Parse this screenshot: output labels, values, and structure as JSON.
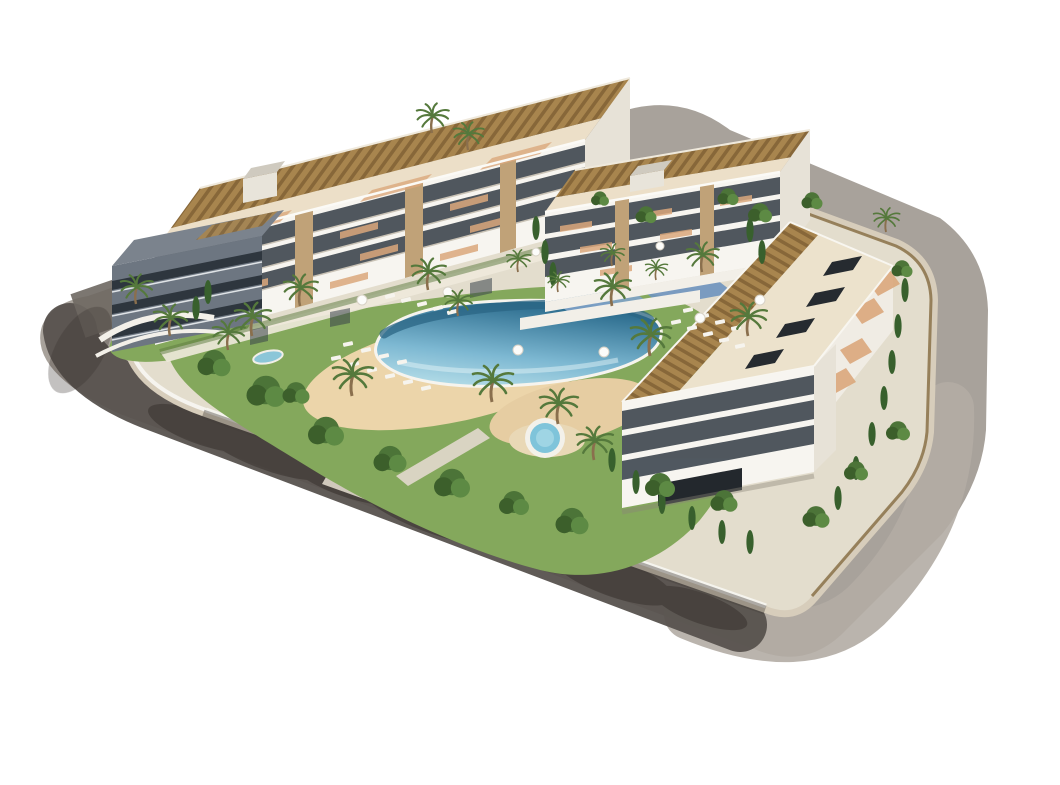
{
  "scene": {
    "type": "architectural-render-aerial",
    "aria_label": "Aerial 3D architectural rendering of a modern white apartment complex with rooftop pergolas, a landscaped courtyard with a lagoon-style swimming pool and sandy beach, a round jacuzzi, palm trees, cypresses and a surrounding ring road",
    "background": "#ffffff"
  },
  "site": {
    "road": {
      "surface_light": "#a8a29b",
      "surface_sunlit": "#b2aca4",
      "surface_shaded": "#57524e",
      "tree_shadow": "#352f2b",
      "sidewalk": "#d7cdbb",
      "entrance_apron": "#d8d1c3"
    },
    "plot": {
      "base": "#e3ddcd",
      "perimeter_wall": "#f6f4ef",
      "lawn": "#84a85c",
      "lawn_dark": "#5d7a40",
      "beach_sand": "#ecd5aa",
      "beach_sand_dark": "#e6cda2",
      "fence": "#8a7148",
      "driveway": "#ddd6c7",
      "walkway": "#eee9db"
    },
    "pool": {
      "water_shallow": "#bfe4ec",
      "water_mid": "#7db8d2",
      "water_deep": "#2f6f90",
      "deep_band": "#2b6584",
      "coping": "#f6f4ee"
    },
    "jacuzzi": {
      "water": "#7fc4da",
      "rim": "#f3f1ea",
      "deck": "#e9d8b6"
    },
    "blue_decks": {
      "deck_a": "#7fa2c8",
      "deck_b": "#6e94bf"
    },
    "pond": {
      "water": "#8cc6d8"
    }
  },
  "buildings": {
    "count": 4,
    "facade_white": "#f7f5f0",
    "facade_shaded": "#e7e2d7",
    "window_band": "#39424b",
    "door_dark": "#23282d",
    "stone_pillar": "#c0a278",
    "pergola": "#a8854e",
    "pergola_slat": "#876739",
    "roof_front": "#ecdfc8",
    "roof_deck": "#ece2cc",
    "terrace_terracotta": "#dba87c",
    "roof_box": "#262b30",
    "bulkhead": "#e8e4da",
    "dark_wing_facade": "#6d7681",
    "dark_wing_band": "#2e363e",
    "blocks": [
      {
        "id": "north-west-block",
        "floors_visible": 4,
        "features": [
          "rooftop pergolas",
          "stone pillars",
          "balcony window bands",
          "roof bulkhead"
        ]
      },
      {
        "id": "north-east-block",
        "floors_visible": 4,
        "features": [
          "rooftop pergolas",
          "roof bulkhead",
          "podium blue decks"
        ]
      },
      {
        "id": "east-block",
        "floors_visible": 4,
        "features": [
          "pergola roof band",
          "roof skylight boxes",
          "street terraces",
          "garage door"
        ]
      },
      {
        "id": "west-shaded-wing",
        "floors_visible": 3,
        "features": [
          "shaded gable facade",
          "dark window strips",
          "curved planter walls"
        ]
      }
    ]
  },
  "vegetation": {
    "palm_frond": "#55793c",
    "leafy": "#4c7438",
    "leafy_dark": "#3c5f2b",
    "leafy_light": "#5d8a44",
    "cypress": "#38602d",
    "trunk": "#8a6f4d"
  },
  "furniture": {
    "lounger": "#f6f4ee",
    "umbrella": "#fcfcfa"
  }
}
